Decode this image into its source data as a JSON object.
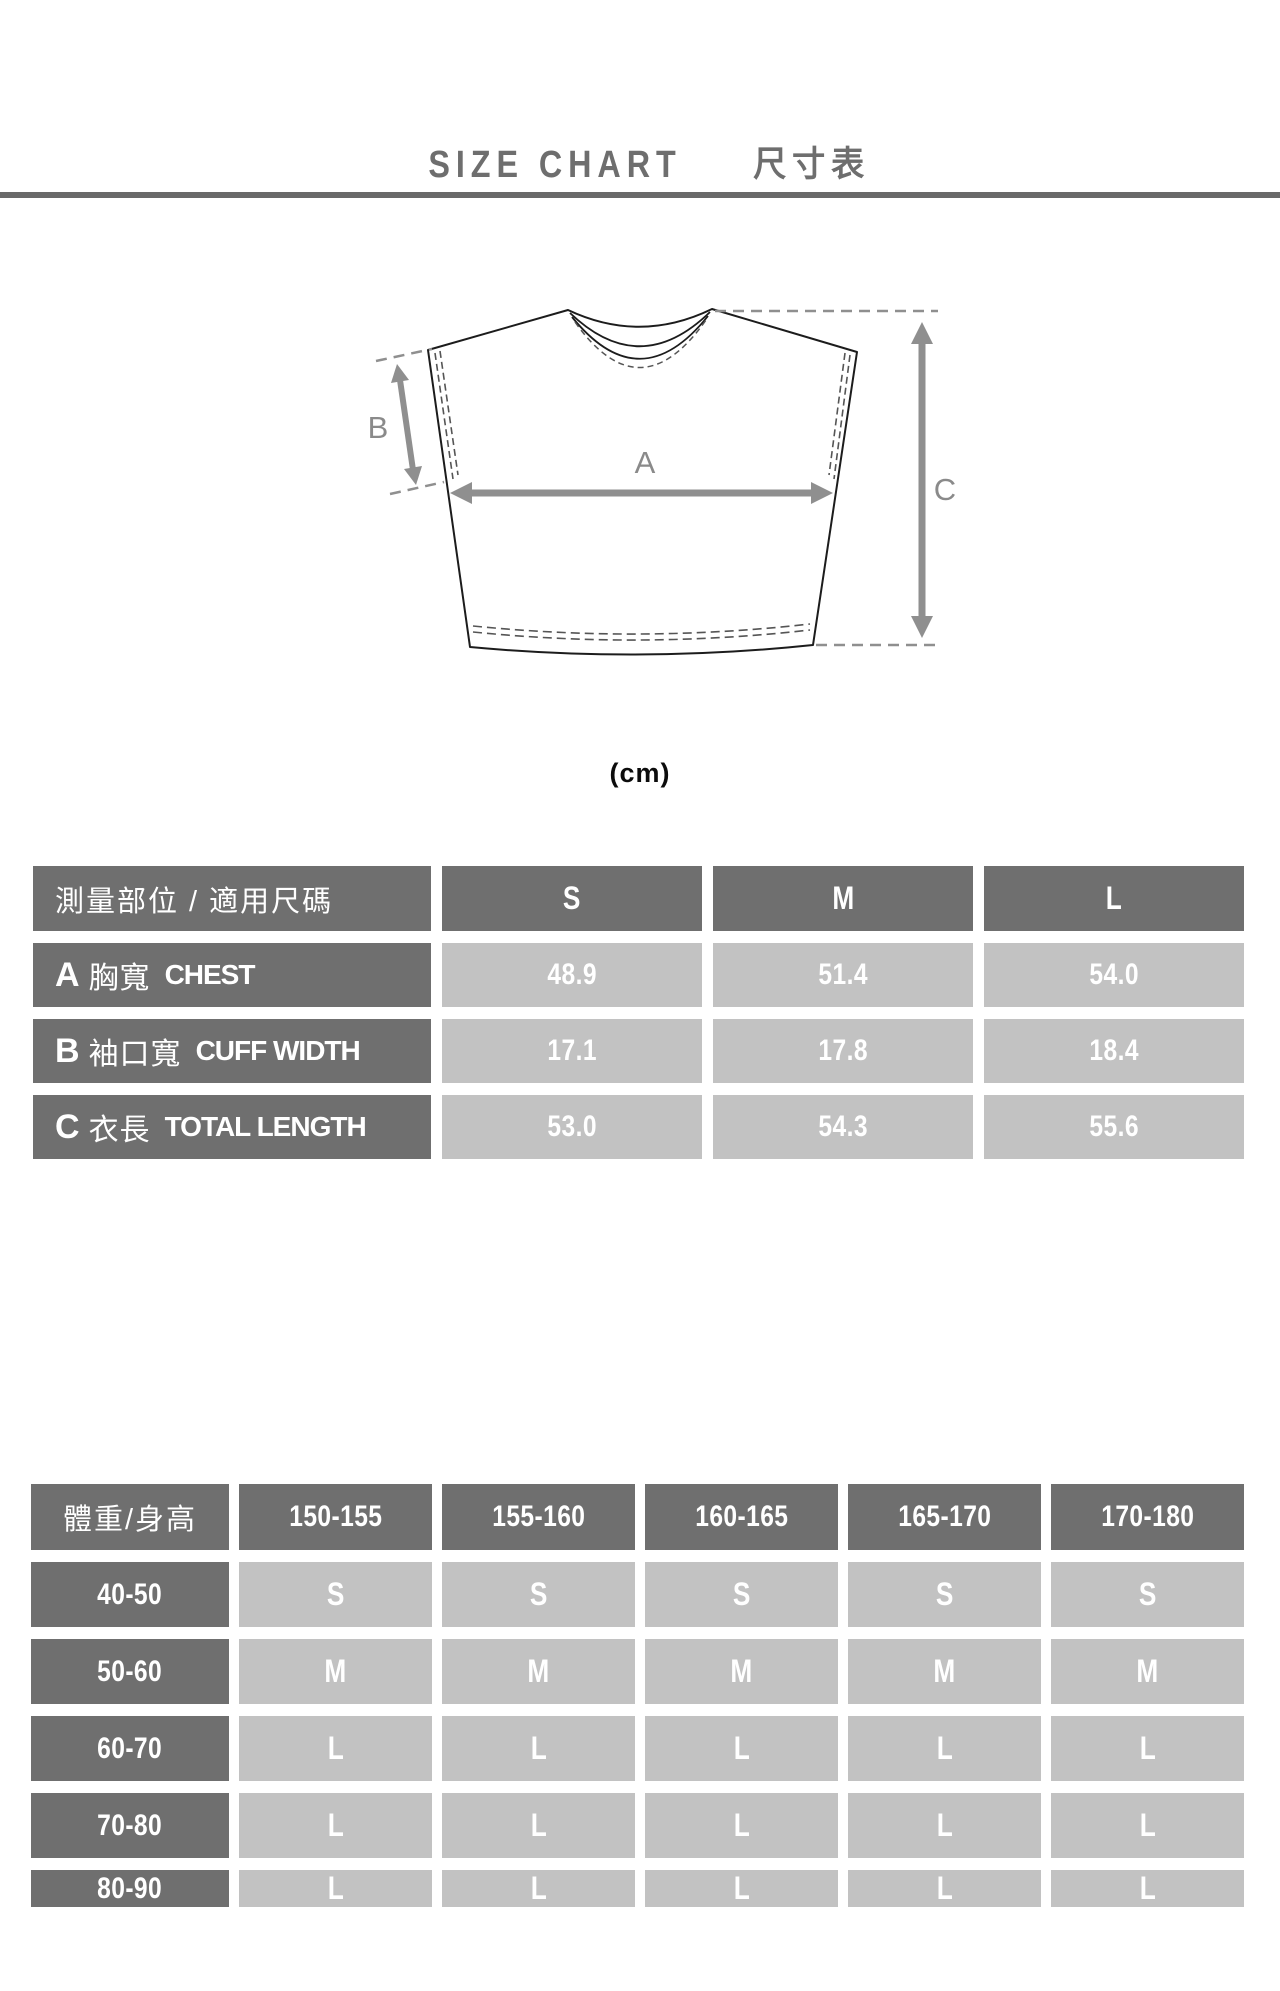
{
  "page": {
    "title_en": "SIZE CHART",
    "title_zh": "尺寸表",
    "unit_label": "(cm)"
  },
  "colors": {
    "header_cell": "#6f6f6f",
    "value_cell": "#c2c2c2",
    "title_text": "#6e6e6e",
    "rule": "#696969",
    "arrow": "#8f8f8f"
  },
  "diagram": {
    "label_a": "A",
    "label_b": "B",
    "label_c": "C"
  },
  "size_table": {
    "header": {
      "label": "測量部位 / 適用尺碼",
      "sizes": [
        "S",
        "M",
        "L"
      ]
    },
    "rows": [
      {
        "letter": "A",
        "zh": "胸寬",
        "en": "CHEST",
        "values": [
          "48.9",
          "51.4",
          "54.0"
        ]
      },
      {
        "letter": "B",
        "zh": "袖口寬",
        "en": "CUFF WIDTH",
        "values": [
          "17.1",
          "17.8",
          "18.4"
        ]
      },
      {
        "letter": "C",
        "zh": "衣長",
        "en": "TOTAL LENGTH",
        "values": [
          "53.0",
          "54.3",
          "55.6"
        ]
      }
    ]
  },
  "fit_table": {
    "header": {
      "label": "體重/身高",
      "ranges": [
        "150-155",
        "155-160",
        "160-165",
        "165-170",
        "170-180"
      ]
    },
    "rows": [
      {
        "label": "40-50",
        "values": [
          "S",
          "S",
          "S",
          "S",
          "S"
        ]
      },
      {
        "label": "50-60",
        "values": [
          "M",
          "M",
          "M",
          "M",
          "M"
        ]
      },
      {
        "label": "60-70",
        "values": [
          "L",
          "L",
          "L",
          "L",
          "L"
        ]
      },
      {
        "label": "70-80",
        "values": [
          "L",
          "L",
          "L",
          "L",
          "L"
        ]
      },
      {
        "label": "80-90",
        "values": [
          "L",
          "L",
          "L",
          "L",
          "L"
        ]
      }
    ]
  },
  "chart_data": [
    {
      "type": "table",
      "title": "SIZE CHART 尺寸表 (cm)",
      "columns": [
        "測量部位 / 適用尺碼",
        "S",
        "M",
        "L"
      ],
      "rows": [
        [
          "A 胸寬 CHEST",
          "48.9",
          "51.4",
          "54.0"
        ],
        [
          "B 袖口寬 CUFF WIDTH",
          "17.1",
          "17.8",
          "18.4"
        ],
        [
          "C 衣長 TOTAL LENGTH",
          "53.0",
          "54.3",
          "55.6"
        ]
      ]
    },
    {
      "type": "table",
      "columns": [
        "體重/身高",
        "150-155",
        "155-160",
        "160-165",
        "165-170",
        "170-180"
      ],
      "rows": [
        [
          "40-50",
          "S",
          "S",
          "S",
          "S",
          "S"
        ],
        [
          "50-60",
          "M",
          "M",
          "M",
          "M",
          "M"
        ],
        [
          "60-70",
          "L",
          "L",
          "L",
          "L",
          "L"
        ],
        [
          "70-80",
          "L",
          "L",
          "L",
          "L",
          "L"
        ],
        [
          "80-90",
          "L",
          "L",
          "L",
          "L",
          "L"
        ]
      ]
    }
  ]
}
